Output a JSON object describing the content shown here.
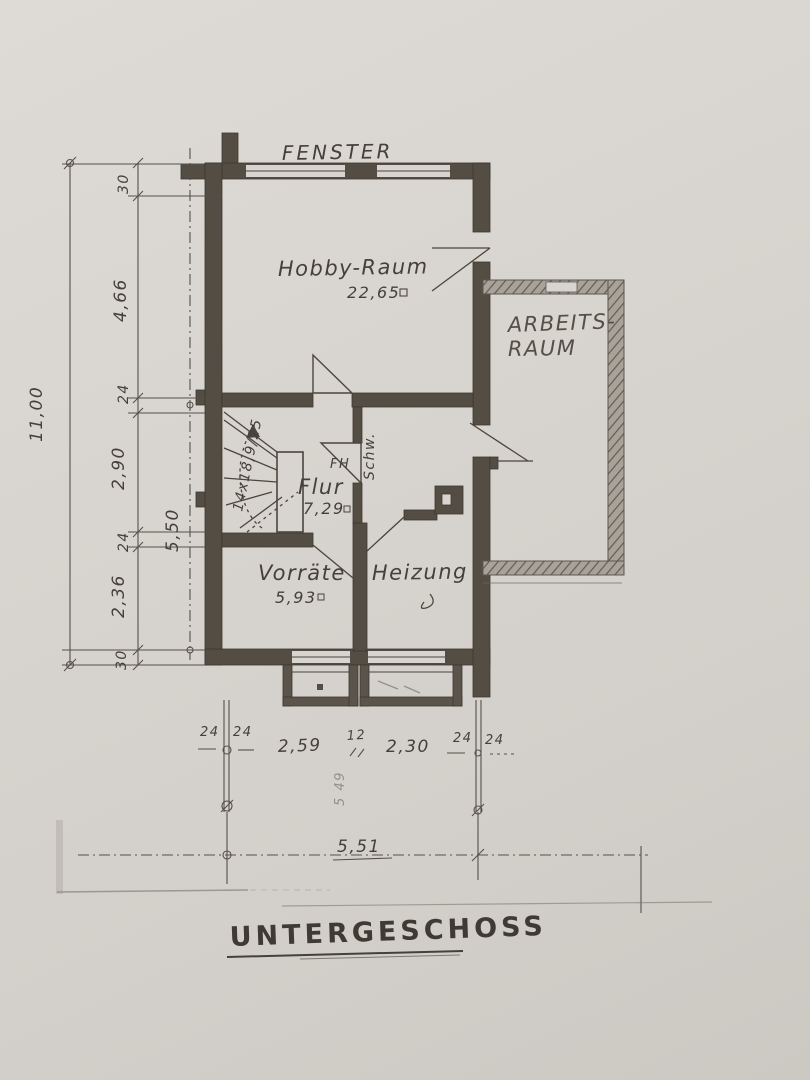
{
  "title": "UNTERGESCHOSS",
  "window_label": "FENSTER",
  "rooms": {
    "hobby": {
      "name": "Hobby-Raum",
      "area": "22,65"
    },
    "arbeit": {
      "name_line1": "ARBEITS-",
      "name_line2": "RAUM"
    },
    "flur": {
      "name": "Flur",
      "area": "7,29"
    },
    "vorraete": {
      "name": "Vorräte",
      "area": "5,93"
    },
    "heizung": {
      "name": "Heizung"
    }
  },
  "stairs": {
    "label": "14x18,9/25"
  },
  "annotations": {
    "fh": "FH",
    "schw": "Schw.",
    "faint": "5 49"
  },
  "dims": {
    "overall_height": "11,00",
    "inner_height": "5,50",
    "left_chain": [
      "30",
      "4,66",
      "24",
      "2,90",
      "24",
      "2,36",
      "30"
    ],
    "bottom_width": "5,51",
    "bottom_chain": {
      "left_a": "24",
      "left_b": "24",
      "seg1": "2,59",
      "mid": "12",
      "seg2": "2,30",
      "right_a": "24",
      "right_b": "24"
    }
  },
  "colors": {
    "paper": "#d8d4cf",
    "ink": "#4b453c",
    "pencil_wall": "#a8a299"
  }
}
